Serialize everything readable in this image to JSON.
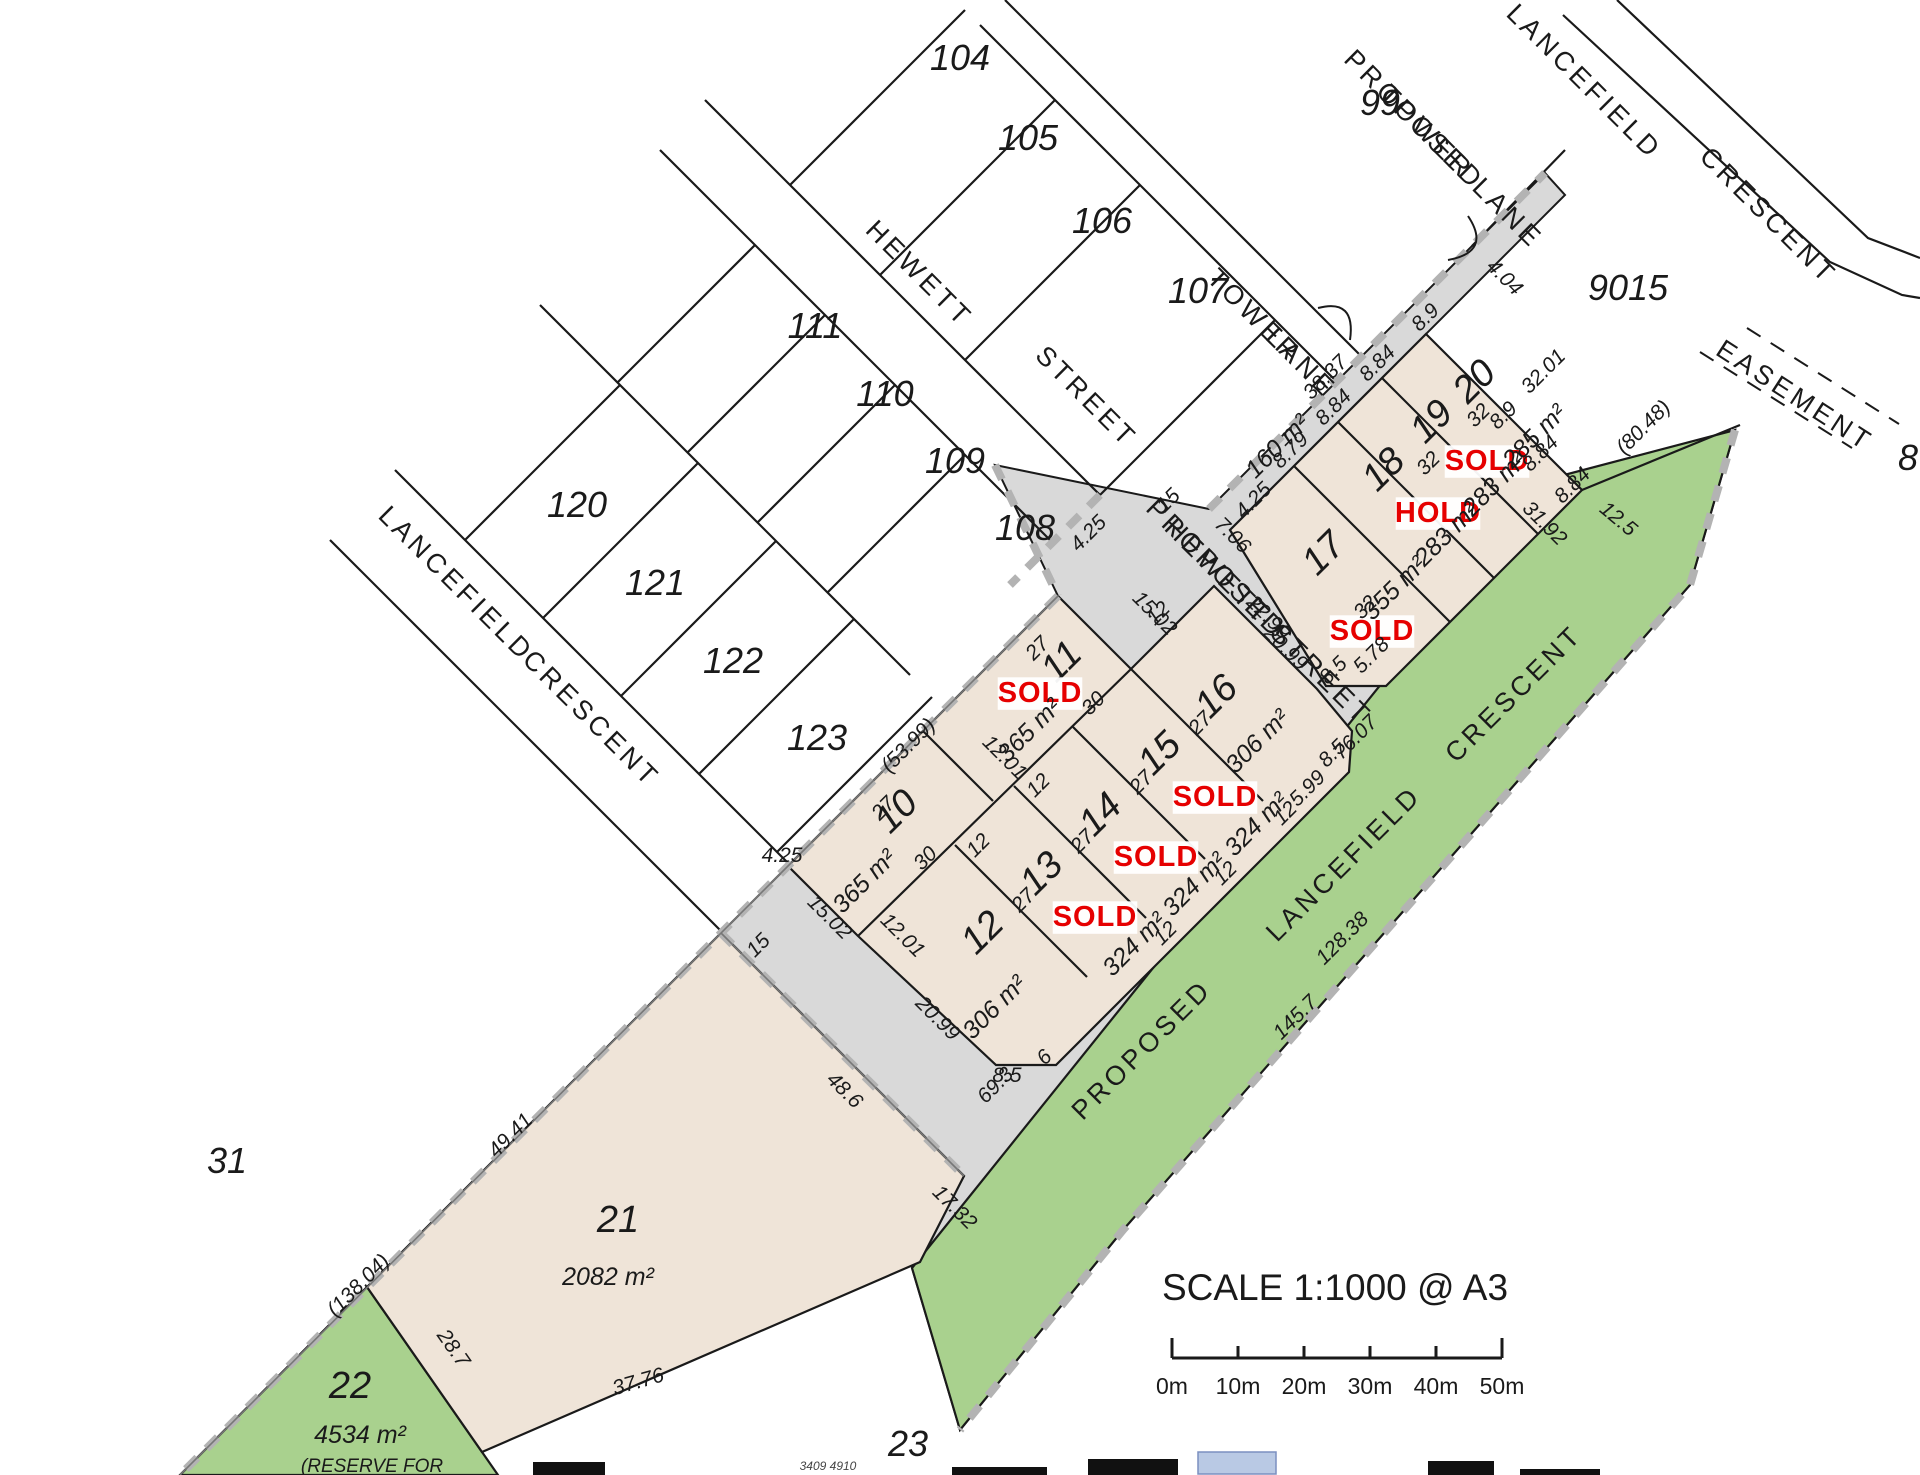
{
  "colors": {
    "parcel_beige": "#EFE4D8",
    "road_grey": "#D9D9D9",
    "reserve_green": "#A9D18E",
    "boundary_dash_grey": "#B3B3B3",
    "status_red": "#e60000",
    "line_black": "#1a1a1a",
    "logo_blue": "#b9c9e4"
  },
  "scale": {
    "text": "SCALE 1:1000 @ A3",
    "ticks": [
      "0m",
      "10m",
      "20m",
      "30m",
      "40m",
      "50m"
    ]
  },
  "lots": [
    {
      "id": "10",
      "area": "365 m²",
      "status": ""
    },
    {
      "id": "11",
      "area": "365 m²",
      "status": "SOLD"
    },
    {
      "id": "12",
      "area": "306 m²",
      "status": ""
    },
    {
      "id": "13",
      "area": "324 m²",
      "status": "SOLD"
    },
    {
      "id": "14",
      "area": "324 m²",
      "status": "SOLD"
    },
    {
      "id": "15",
      "area": "324 m²",
      "status": "SOLD"
    },
    {
      "id": "16",
      "area": "306 m²",
      "status": ""
    },
    {
      "id": "17",
      "area": "355 m²",
      "status": "SOLD"
    },
    {
      "id": "18",
      "area": "283 m²",
      "status": "HOLD"
    },
    {
      "id": "19",
      "area": "283 m²",
      "status": "SOLD"
    },
    {
      "id": "20",
      "area": "285 m²",
      "status": ""
    },
    {
      "id": "21",
      "area": "2082 m²",
      "status": ""
    },
    {
      "id": "22",
      "area": "4534 m²",
      "status": ""
    },
    {
      "id": "9015",
      "area": "",
      "status": ""
    },
    {
      "id": "lane",
      "area": "160 m²",
      "status": ""
    }
  ],
  "streets": [
    "HEWETT STREET",
    "TOWER LANE",
    "PROPOSED TOWER LANE",
    "LANCEFIELD CRESCENT",
    "PROPOSED HEWETT STREET",
    "PROPOSED LANCEFIELD CRESCENT",
    "EASEMENT"
  ],
  "labels": [
    {
      "n": "lot-104-number",
      "t": "104",
      "x": 960,
      "y": 70,
      "r": 0,
      "c": "lot"
    },
    {
      "n": "lot-105-number",
      "t": "105",
      "x": 1028,
      "y": 150,
      "r": 0,
      "c": "lot"
    },
    {
      "n": "lot-106-number",
      "t": "106",
      "x": 1102,
      "y": 233,
      "r": 0,
      "c": "lot"
    },
    {
      "n": "lot-107-number",
      "t": "107",
      "x": 1198,
      "y": 303,
      "r": 0,
      "c": "lot"
    },
    {
      "n": "lot-99-number",
      "t": "99",
      "x": 1380,
      "y": 115,
      "r": 0,
      "c": "lot"
    },
    {
      "n": "lot-9015-number",
      "t": "9015",
      "x": 1628,
      "y": 300,
      "r": 0,
      "c": "lot"
    },
    {
      "n": "lot-111-number",
      "t": "111",
      "x": 815,
      "y": 338,
      "r": 0,
      "c": "lot"
    },
    {
      "n": "lot-110-number",
      "t": "110",
      "x": 885,
      "y": 406,
      "r": 0,
      "c": "lot"
    },
    {
      "n": "lot-109-number",
      "t": "109",
      "x": 955,
      "y": 473,
      "r": 0,
      "c": "lot"
    },
    {
      "n": "lot-108-number",
      "t": "108",
      "x": 1025,
      "y": 540,
      "r": 0,
      "c": "lot"
    },
    {
      "n": "lot-120-number",
      "t": "120",
      "x": 577,
      "y": 517,
      "r": 0,
      "c": "lot"
    },
    {
      "n": "lot-121-number",
      "t": "121",
      "x": 655,
      "y": 595,
      "r": 0,
      "c": "lot"
    },
    {
      "n": "lot-122-number",
      "t": "122",
      "x": 733,
      "y": 673,
      "r": 0,
      "c": "lot"
    },
    {
      "n": "lot-123-number",
      "t": "123",
      "x": 817,
      "y": 750,
      "r": 0,
      "c": "lot"
    },
    {
      "n": "lot-31-number",
      "t": "31",
      "x": 227,
      "y": 1173,
      "r": 0,
      "c": "lot"
    },
    {
      "n": "street-hewett-1",
      "t": "HEWETT",
      "x": 913,
      "y": 280,
      "r": 45,
      "c": "street"
    },
    {
      "n": "street-hewett-2",
      "t": "STREET",
      "x": 1080,
      "y": 403,
      "r": 45,
      "c": "street"
    },
    {
      "n": "street-tower-1",
      "t": "TOWER",
      "x": 1248,
      "y": 322,
      "r": 45,
      "c": "street"
    },
    {
      "n": "street-tower-2",
      "t": "LANE",
      "x": 1295,
      "y": 369,
      "r": 45,
      "c": "street"
    },
    {
      "n": "street-proposed-tower-1",
      "t": "PROPOSED",
      "x": 1408,
      "y": 126,
      "r": 45,
      "c": "street"
    },
    {
      "n": "street-proposed-tower-2",
      "t": "TOWER LANE",
      "x": 1455,
      "y": 173,
      "r": 45,
      "c": "street"
    },
    {
      "n": "street-lancefield-tr-1",
      "t": "LANCEFIELD",
      "x": 1578,
      "y": 88,
      "r": 45,
      "c": "street"
    },
    {
      "n": "street-lancefield-tr-2",
      "t": "CRESCENT",
      "x": 1762,
      "y": 222,
      "r": 45,
      "c": "street"
    },
    {
      "n": "street-lancefield-old-1",
      "t": "LANCEFIELD",
      "x": 450,
      "y": 590,
      "r": 45,
      "c": "street"
    },
    {
      "n": "street-lancefield-old-2",
      "t": "CRESCENT",
      "x": 585,
      "y": 725,
      "r": 45,
      "c": "street"
    },
    {
      "n": "street-proposed-hewett-1",
      "t": "PROPOSED",
      "x": 1210,
      "y": 575,
      "r": 45,
      "c": "street"
    },
    {
      "n": "street-proposed-hewett-2",
      "t": "HEWETT STREET",
      "x": 1262,
      "y": 628,
      "r": 45,
      "c": "street"
    },
    {
      "n": "street-proposed-lancefield-1",
      "t": "PROPOSED",
      "x": 1148,
      "y": 1056,
      "r": -45,
      "c": "street"
    },
    {
      "n": "street-proposed-lancefield-2",
      "t": "LANCEFIELD",
      "x": 1350,
      "y": 870,
      "r": -45,
      "c": "street"
    },
    {
      "n": "street-proposed-lancefield-3",
      "t": "CRESCENT",
      "x": 1520,
      "y": 700,
      "r": -45,
      "c": "street"
    },
    {
      "n": "easement-label",
      "t": "EASEMENT",
      "x": 1790,
      "y": 403,
      "r": 33,
      "c": "street"
    },
    {
      "n": "lot-11-number",
      "t": "11",
      "x": 1070,
      "y": 670,
      "r": -45,
      "c": "lotbig"
    },
    {
      "n": "lot-11-status",
      "t": "SOLD",
      "x": 1040,
      "y": 702,
      "r": 0,
      "c": "status",
      "bg": 1
    },
    {
      "n": "lot-11-area",
      "t": "365 m²",
      "x": 1035,
      "y": 736,
      "r": -45,
      "c": "area"
    },
    {
      "n": "lot-10-number",
      "t": "10",
      "x": 905,
      "y": 820,
      "r": -45,
      "c": "lotbig"
    },
    {
      "n": "lot-10-area",
      "t": "365 m²",
      "x": 870,
      "y": 887,
      "r": -45,
      "c": "area"
    },
    {
      "n": "lot-16-number",
      "t": "16",
      "x": 1225,
      "y": 705,
      "r": -45,
      "c": "lotbig"
    },
    {
      "n": "lot-16-area",
      "t": "306 m²",
      "x": 1263,
      "y": 747,
      "r": -45,
      "c": "area"
    },
    {
      "n": "lot-15-number",
      "t": "15",
      "x": 1168,
      "y": 762,
      "r": -45,
      "c": "lotbig"
    },
    {
      "n": "lot-15-status",
      "t": "SOLD",
      "x": 1215,
      "y": 806,
      "r": 0,
      "c": "status",
      "bg": 1
    },
    {
      "n": "lot-15-area",
      "t": "324 m²",
      "x": 1262,
      "y": 830,
      "r": -45,
      "c": "area"
    },
    {
      "n": "lot-14-number",
      "t": "14",
      "x": 1109,
      "y": 823,
      "r": -45,
      "c": "lotbig"
    },
    {
      "n": "lot-14-status",
      "t": "SOLD",
      "x": 1156,
      "y": 866,
      "r": 0,
      "c": "status",
      "bg": 1
    },
    {
      "n": "lot-14-area",
      "t": "324 m²",
      "x": 1200,
      "y": 890,
      "r": -45,
      "c": "area"
    },
    {
      "n": "lot-13-number",
      "t": "13",
      "x": 1050,
      "y": 882,
      "r": -45,
      "c": "lotbig"
    },
    {
      "n": "lot-13-status",
      "t": "SOLD",
      "x": 1095,
      "y": 926,
      "r": 0,
      "c": "status",
      "bg": 1
    },
    {
      "n": "lot-13-area",
      "t": "324 m²",
      "x": 1140,
      "y": 950,
      "r": -45,
      "c": "area"
    },
    {
      "n": "lot-12-number",
      "t": "12",
      "x": 991,
      "y": 941,
      "r": -45,
      "c": "lotbig"
    },
    {
      "n": "lot-12-area",
      "t": "306 m²",
      "x": 1000,
      "y": 1013,
      "r": -45,
      "c": "area"
    },
    {
      "n": "lot-17-number",
      "t": "17",
      "x": 1332,
      "y": 562,
      "r": -45,
      "c": "lotbig"
    },
    {
      "n": "lot-17-status",
      "t": "SOLD",
      "x": 1372,
      "y": 640,
      "r": 0,
      "c": "status",
      "bg": 1
    },
    {
      "n": "lot-17-area",
      "t": "355 m²",
      "x": 1400,
      "y": 594,
      "r": -45,
      "c": "area"
    },
    {
      "n": "lot-18-number",
      "t": "18",
      "x": 1392,
      "y": 478,
      "r": -45,
      "c": "lotbig"
    },
    {
      "n": "lot-18-status",
      "t": "HOLD",
      "x": 1438,
      "y": 522,
      "r": 0,
      "c": "status",
      "bg": 1
    },
    {
      "n": "lot-18-area",
      "t": "283 m²",
      "x": 1452,
      "y": 540,
      "r": -45,
      "c": "area"
    },
    {
      "n": "lot-19-number",
      "t": "19",
      "x": 1440,
      "y": 430,
      "r": -45,
      "c": "lotbig"
    },
    {
      "n": "lot-19-status",
      "t": "SOLD",
      "x": 1487,
      "y": 470,
      "r": 0,
      "c": "status",
      "bg": 1
    },
    {
      "n": "lot-19-area",
      "t": "283 m²",
      "x": 1500,
      "y": 490,
      "r": -45,
      "c": "area"
    },
    {
      "n": "lot-20-number",
      "t": "20",
      "x": 1483,
      "y": 390,
      "r": -45,
      "c": "lotbig"
    },
    {
      "n": "lot-20-area",
      "t": "285 m²",
      "x": 1540,
      "y": 442,
      "r": -45,
      "c": "area"
    },
    {
      "n": "lane-area",
      "t": "160 m²",
      "x": 1283,
      "y": 452,
      "r": -45,
      "c": "area"
    },
    {
      "n": "lot-21-number",
      "t": "21",
      "x": 618,
      "y": 1232,
      "r": 0,
      "c": "lotbig"
    },
    {
      "n": "lot-21-area",
      "t": "2082 m²",
      "x": 608,
      "y": 1285,
      "r": 0,
      "c": "area"
    },
    {
      "n": "lot-22-number",
      "t": "22",
      "x": 350,
      "y": 1398,
      "r": 0,
      "c": "lotbig"
    },
    {
      "n": "lot-22-area",
      "t": "4534 m²",
      "x": 360,
      "y": 1443,
      "r": 0,
      "c": "area"
    },
    {
      "n": "lot-22-reserve",
      "t": "(RESERVE FOR",
      "x": 372,
      "y": 1472,
      "r": 0,
      "c": "small"
    },
    {
      "n": "dim-4-04",
      "t": "4.04",
      "x": 1500,
      "y": 282,
      "r": 45,
      "c": "dim"
    },
    {
      "n": "dim-8-9-lane",
      "t": "8.9",
      "x": 1430,
      "y": 322,
      "r": -45,
      "c": "dim"
    },
    {
      "n": "dim-8-84-a",
      "t": "8.84",
      "x": 1382,
      "y": 368,
      "r": -45,
      "c": "dim"
    },
    {
      "n": "dim-8-84-b",
      "t": "8.84",
      "x": 1338,
      "y": 412,
      "r": -45,
      "c": "dim"
    },
    {
      "n": "dim-8-79",
      "t": "8.79",
      "x": 1295,
      "y": 455,
      "r": -45,
      "c": "dim"
    },
    {
      "n": "dim-4-25-lane",
      "t": "4.25",
      "x": 1258,
      "y": 505,
      "r": -45,
      "c": "dim"
    },
    {
      "n": "dim-38-37",
      "t": "38.37",
      "x": 1330,
      "y": 382,
      "r": -45,
      "c": "dim"
    },
    {
      "n": "dim-7-06",
      "t": "7.06",
      "x": 1228,
      "y": 540,
      "r": 45,
      "c": "dim"
    },
    {
      "n": "dim-15-junction",
      "t": "15",
      "x": 1173,
      "y": 505,
      "r": -45,
      "c": "dim"
    },
    {
      "n": "dim-4-25-junction",
      "t": "4.25",
      "x": 1093,
      "y": 538,
      "r": -45,
      "c": "dim"
    },
    {
      "n": "dim-32-01",
      "t": "32.01",
      "x": 1548,
      "y": 376,
      "r": -45,
      "c": "dim"
    },
    {
      "n": "dim-32-17",
      "t": "32",
      "x": 1370,
      "y": 612,
      "r": -45,
      "c": "dim"
    },
    {
      "n": "dim-32-18",
      "t": "32",
      "x": 1433,
      "y": 468,
      "r": -45,
      "c": "dim"
    },
    {
      "n": "dim-32-19",
      "t": "32",
      "x": 1483,
      "y": 420,
      "r": -45,
      "c": "dim"
    },
    {
      "n": "dim-22-99",
      "t": "22.99",
      "x": 1264,
      "y": 622,
      "r": 45,
      "c": "dim"
    },
    {
      "n": "dim-8-5-17",
      "t": "8.5",
      "x": 1338,
      "y": 675,
      "r": -45,
      "c": "dim"
    },
    {
      "n": "dim-5-78",
      "t": "5.78",
      "x": 1376,
      "y": 660,
      "r": -45,
      "c": "dim"
    },
    {
      "n": "dim-80-48",
      "t": "(80.48)",
      "x": 1648,
      "y": 432,
      "r": -45,
      "c": "dim"
    },
    {
      "n": "dim-12-5",
      "t": "12.5",
      "x": 1614,
      "y": 524,
      "r": 40,
      "c": "dim"
    },
    {
      "n": "dim-8-9-ne",
      "t": "8.9",
      "x": 1508,
      "y": 420,
      "r": -45,
      "c": "dim"
    },
    {
      "n": "dim-8-84-ne1",
      "t": "8.84",
      "x": 1545,
      "y": 458,
      "r": -45,
      "c": "dim"
    },
    {
      "n": "dim-8-84-ne2",
      "t": "8.84",
      "x": 1577,
      "y": 490,
      "r": -45,
      "c": "dim"
    },
    {
      "n": "dim-15-02-a",
      "t": "15.02",
      "x": 1150,
      "y": 618,
      "r": 45,
      "c": "dim"
    },
    {
      "n": "dim-15-02-b",
      "t": "15.02",
      "x": 825,
      "y": 922,
      "r": 45,
      "c": "dim"
    },
    {
      "n": "dim-12-01-a",
      "t": "12.01",
      "x": 1000,
      "y": 762,
      "r": 45,
      "c": "dim"
    },
    {
      "n": "dim-12-01-b",
      "t": "12.01",
      "x": 898,
      "y": 940,
      "r": 45,
      "c": "dim"
    },
    {
      "n": "dim-27-11",
      "t": "27",
      "x": 1042,
      "y": 653,
      "r": -45,
      "c": "dim"
    },
    {
      "n": "dim-27-10",
      "t": "27",
      "x": 888,
      "y": 813,
      "r": -45,
      "c": "dim"
    },
    {
      "n": "dim-30-11",
      "t": "30",
      "x": 1098,
      "y": 708,
      "r": -45,
      "c": "dim"
    },
    {
      "n": "dim-30-10",
      "t": "30",
      "x": 930,
      "y": 863,
      "r": -45,
      "c": "dim"
    },
    {
      "n": "dim-27-16",
      "t": "27",
      "x": 1205,
      "y": 728,
      "r": -45,
      "c": "dim"
    },
    {
      "n": "dim-27-15",
      "t": "27",
      "x": 1146,
      "y": 787,
      "r": -45,
      "c": "dim"
    },
    {
      "n": "dim-27-14",
      "t": "27",
      "x": 1087,
      "y": 846,
      "r": -45,
      "c": "dim"
    },
    {
      "n": "dim-27-13",
      "t": "27",
      "x": 1028,
      "y": 905,
      "r": -45,
      "c": "dim"
    },
    {
      "n": "dim-20-99-16",
      "t": "20.99",
      "x": 1281,
      "y": 653,
      "r": 45,
      "c": "dim"
    },
    {
      "n": "dim-20-99-12",
      "t": "20.99",
      "x": 933,
      "y": 1023,
      "r": 45,
      "c": "dim"
    },
    {
      "n": "dim-8-5-16",
      "t": "8.5",
      "x": 1337,
      "y": 758,
      "r": -45,
      "c": "dim"
    },
    {
      "n": "dim-5-99",
      "t": "5.99",
      "x": 1312,
      "y": 793,
      "r": -45,
      "c": "dim"
    },
    {
      "n": "dim-8-5-12",
      "t": "8.5",
      "x": 1007,
      "y": 1082,
      "r": 0,
      "c": "dim"
    },
    {
      "n": "dim-6-12",
      "t": "6",
      "x": 1049,
      "y": 1062,
      "r": -45,
      "c": "dim"
    },
    {
      "n": "dim-12-t1",
      "t": "12",
      "x": 1163,
      "y": 618,
      "r": -45,
      "c": "dim"
    },
    {
      "n": "dim-12-t2",
      "t": "12",
      "x": 1043,
      "y": 790,
      "r": -45,
      "c": "dim"
    },
    {
      "n": "dim-12-t3",
      "t": "12",
      "x": 983,
      "y": 850,
      "r": -45,
      "c": "dim"
    },
    {
      "n": "dim-12-t4",
      "t": "12",
      "x": 1290,
      "y": 818,
      "r": -45,
      "c": "dim"
    },
    {
      "n": "dim-12-t5",
      "t": "12",
      "x": 1230,
      "y": 878,
      "r": -45,
      "c": "dim"
    },
    {
      "n": "dim-12-t6",
      "t": "12",
      "x": 1170,
      "y": 938,
      "r": -45,
      "c": "dim"
    },
    {
      "n": "dim-53-99",
      "t": "(53.99)",
      "x": 913,
      "y": 750,
      "r": -45,
      "c": "dim"
    },
    {
      "n": "dim-4-25-corner",
      "t": "4.25",
      "x": 782,
      "y": 862,
      "r": 0,
      "c": "dim"
    },
    {
      "n": "dim-15-stub",
      "t": "15",
      "x": 763,
      "y": 950,
      "r": -45,
      "c": "dim"
    },
    {
      "n": "dim-49-41",
      "t": "49.41",
      "x": 515,
      "y": 1140,
      "r": -45,
      "c": "dim"
    },
    {
      "n": "dim-138-04",
      "t": "(138.04)",
      "x": 363,
      "y": 1290,
      "r": -45,
      "c": "dim"
    },
    {
      "n": "dim-48-6",
      "t": "48.6",
      "x": 840,
      "y": 1095,
      "r": 45,
      "c": "dim"
    },
    {
      "n": "dim-17-32",
      "t": "17.32",
      "x": 950,
      "y": 1212,
      "r": 45,
      "c": "dim"
    },
    {
      "n": "dim-37-76",
      "t": "37.76",
      "x": 640,
      "y": 1388,
      "r": -16,
      "c": "dim"
    },
    {
      "n": "dim-28-7",
      "t": "28.7",
      "x": 448,
      "y": 1352,
      "r": 55,
      "c": "dim"
    },
    {
      "n": "dim-128-38",
      "t": "128.38",
      "x": 1347,
      "y": 943,
      "r": -45,
      "c": "dim"
    },
    {
      "n": "dim-145-7",
      "t": "145.7",
      "x": 1300,
      "y": 1022,
      "r": -45,
      "c": "dim"
    },
    {
      "n": "dim-69-3",
      "t": "69.3",
      "x": 1000,
      "y": 1090,
      "r": -45,
      "c": "dim"
    },
    {
      "n": "dim-76-07",
      "t": "76.07",
      "x": 1360,
      "y": 742,
      "r": -45,
      "c": "dim"
    },
    {
      "n": "dim-31-92",
      "t": "31.92",
      "x": 1540,
      "y": 528,
      "r": 45,
      "c": "dim"
    },
    {
      "n": "edge-cut-8",
      "t": "8",
      "x": 1908,
      "y": 470,
      "r": 0,
      "c": "lot"
    },
    {
      "n": "edge-cut-23",
      "t": "23",
      "x": 908,
      "y": 1456,
      "r": 0,
      "c": "lot"
    },
    {
      "n": "edge-cut-numbers",
      "t": "3409  4910",
      "x": 828,
      "y": 1470,
      "r": 0,
      "c": "tiny"
    }
  ]
}
